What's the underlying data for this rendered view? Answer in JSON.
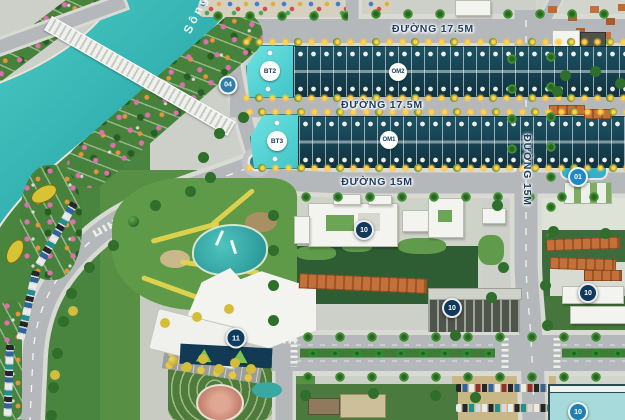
{
  "labels": {
    "river": "Sông",
    "street_17_5_a": "ĐƯỜNG 17.5M",
    "street_17_5_b": "ĐƯỜNG 17.5M",
    "street_15_h": "ĐƯỜNG 15M",
    "street_15_v": "ĐƯỜNG 15M",
    "bt2": "BT2",
    "bt3": "BT3",
    "om2": "OM2",
    "om1": "OM1"
  },
  "badges": {
    "b04": "04",
    "b01": "01",
    "b10_civic": "10",
    "b10_block": "10",
    "b10_east": "10",
    "b10_south": "10",
    "b11": "11"
  },
  "colors": {
    "water": "#35b2b4",
    "road": "#b5b8ba",
    "sidewalk": "#d9dad4",
    "park_green": "#4a8540",
    "lot_strip_teal": "#16424e",
    "corner_lot_cyan": "#4fd6d6",
    "street_label_navy": "#1d3e63",
    "badge_navy": "#10395c",
    "badge_blue": "#2088c4",
    "badge_teal_blue": "#2e7ca8",
    "roof_orange": "#c4703a"
  }
}
